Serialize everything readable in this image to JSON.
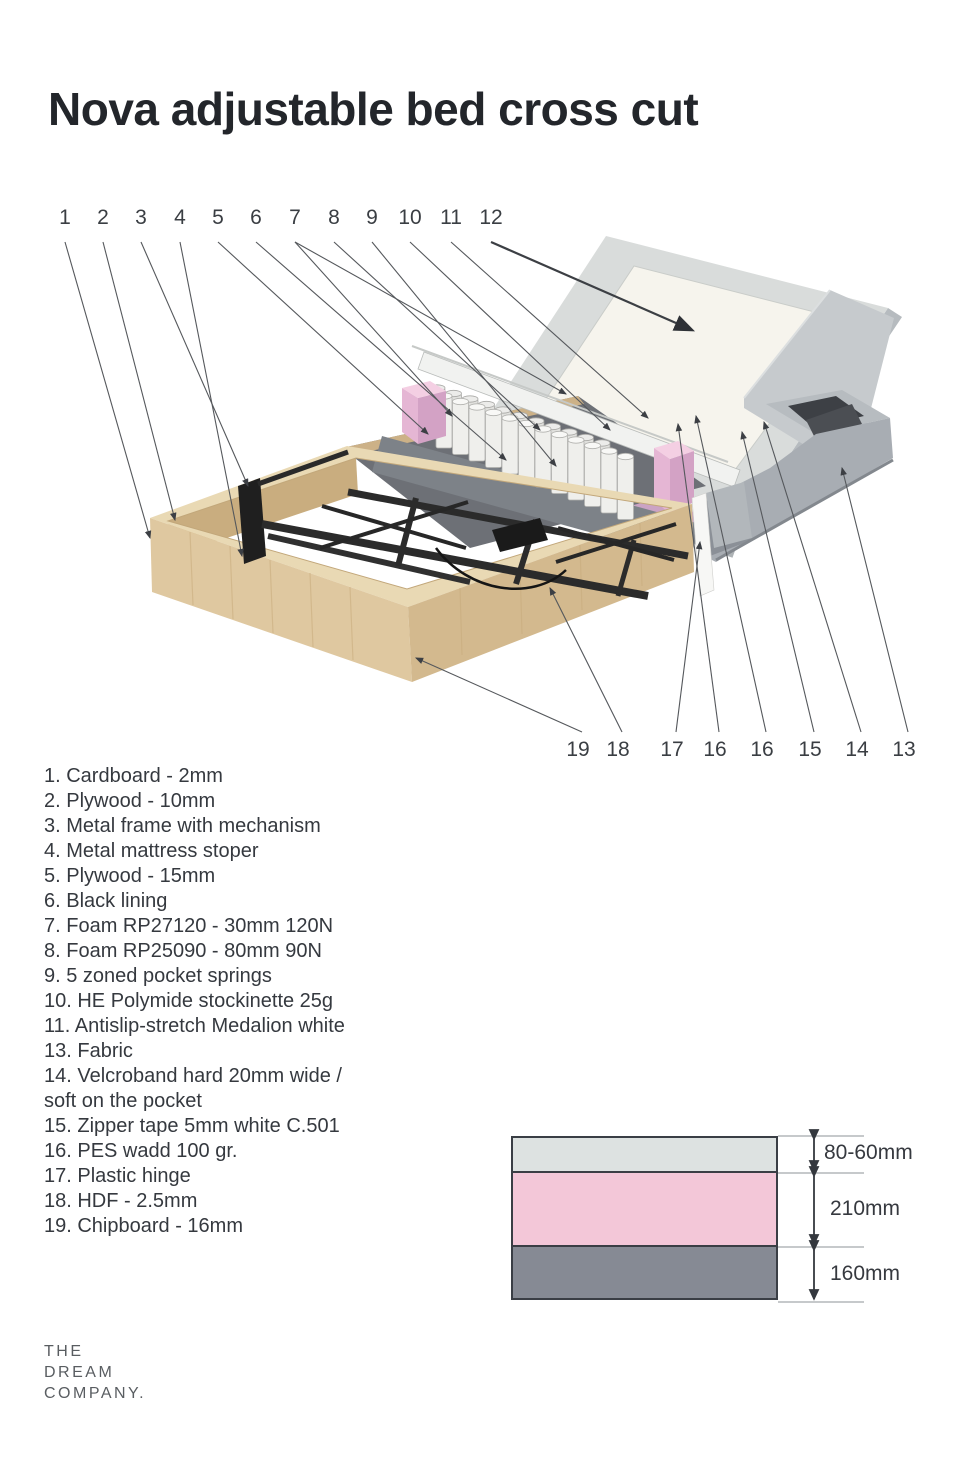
{
  "title": "Nova adjustable bed cross cut",
  "diagram": {
    "top_callouts": [
      "1",
      "2",
      "3",
      "4",
      "5",
      "6",
      "7",
      "8",
      "9",
      "10",
      "11",
      "12"
    ],
    "bottom_callouts": [
      "19",
      "18",
      "17",
      "16",
      "16",
      "15",
      "14",
      "13"
    ]
  },
  "legend": {
    "items": [
      "1. Cardboard - 2mm",
      "2. Plywood - 10mm",
      "3. Metal frame with mechanism",
      "4. Metal mattress stoper",
      "5. Plywood - 15mm",
      "6. Black lining",
      "7. Foam RP27120 - 30mm 120N",
      "8. Foam RP25090 - 80mm 90N",
      "9. 5 zoned pocket springs",
      "10. HE Polymide stockinette 25g",
      "11. Antislip-stretch Medalion white",
      "13. Fabric",
      "14. Velcroband hard 20mm wide /\nsoft on the pocket",
      "15. Zipper tape 5mm white C.501",
      "16. PES wadd 100 gr.",
      "17. Plastic hinge",
      "18. HDF - 2.5mm",
      "19. Chipboard - 16mm"
    ]
  },
  "measurement_diagram": {
    "layers": [
      {
        "label": "80-60mm",
        "color": "#dde2e1"
      },
      {
        "label": "210mm",
        "color": "#f3c7d8"
      },
      {
        "label": "160mm",
        "color": "#868a94"
      }
    ]
  },
  "logo": {
    "lines": [
      "THE",
      "DREAM",
      "COMPANY."
    ]
  },
  "colors": {
    "foam_pink": "#e5b6d4",
    "mattress_pink_layer": "#cba3c4",
    "wood": "#dfc8a0",
    "metal_dark": "#262626",
    "base_gray": "#a8adb3",
    "text": "#35393f"
  }
}
